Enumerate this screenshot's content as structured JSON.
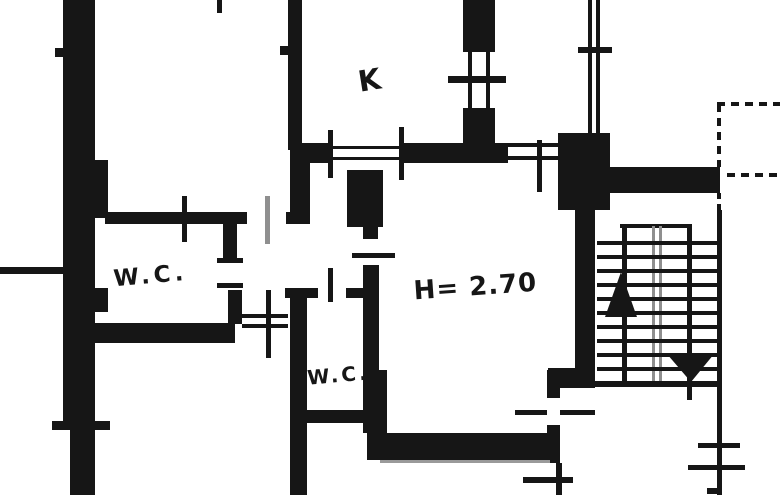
{
  "canvas": {
    "width": 780,
    "height": 495,
    "bg": "#ffffff",
    "ink": "#161616",
    "gray": "#8f8f8f"
  },
  "labels": [
    {
      "id": "label-kitchen",
      "text": "K",
      "x": 371,
      "y": 90,
      "size": 29,
      "rotate": -9,
      "spacing": 0
    },
    {
      "id": "label-wc-1",
      "text": "W.C.",
      "x": 151,
      "y": 283,
      "size": 23,
      "rotate": -5,
      "spacing": 4
    },
    {
      "id": "label-wc-2",
      "text": "W.C.",
      "x": 339,
      "y": 382,
      "size": 20,
      "rotate": -5,
      "spacing": 3
    },
    {
      "id": "label-height",
      "text": "H= 2.70",
      "x": 476,
      "y": 295,
      "size": 26,
      "rotate": -4,
      "spacing": 1
    }
  ],
  "plan": {
    "elements": [
      {
        "t": "rect",
        "n": "wall",
        "x": 63,
        "y": 0,
        "w": 32,
        "h": 160
      },
      {
        "t": "rect",
        "n": "wall",
        "x": 63,
        "y": 160,
        "w": 45,
        "h": 58
      },
      {
        "t": "rect",
        "n": "wall",
        "x": 63,
        "y": 218,
        "w": 32,
        "h": 108
      },
      {
        "t": "rect",
        "n": "wall",
        "x": 63,
        "y": 326,
        "w": 32,
        "h": 104
      },
      {
        "t": "rect",
        "n": "wall",
        "x": 95,
        "y": 288,
        "w": 13,
        "h": 24
      },
      {
        "t": "rect",
        "n": "wall",
        "x": 70,
        "y": 430,
        "w": 25,
        "h": 65
      },
      {
        "t": "rect",
        "n": "door-tick",
        "x": 55,
        "y": 48,
        "w": 9,
        "h": 9
      },
      {
        "t": "rect",
        "n": "wall",
        "x": 0,
        "y": 267,
        "w": 63,
        "h": 7
      },
      {
        "t": "rect",
        "n": "door-tick",
        "x": 52,
        "y": 421,
        "w": 58,
        "h": 9
      },
      {
        "t": "rect",
        "n": "wall-stub",
        "x": 217,
        "y": 0,
        "w": 5,
        "h": 13
      },
      {
        "t": "rect",
        "n": "wall",
        "x": 288,
        "y": 0,
        "w": 14,
        "h": 150
      },
      {
        "t": "rect",
        "n": "door-tick",
        "x": 280,
        "y": 46,
        "w": 8,
        "h": 9
      },
      {
        "t": "rect",
        "n": "wall",
        "x": 290,
        "y": 143,
        "w": 20,
        "h": 81
      },
      {
        "t": "rect",
        "n": "wall",
        "x": 295,
        "y": 143,
        "w": 38,
        "h": 20
      },
      {
        "t": "rect",
        "n": "wall",
        "x": 402,
        "y": 143,
        "w": 106,
        "h": 20
      },
      {
        "t": "rect",
        "n": "door-threshold-line",
        "x": 333,
        "y": 146,
        "w": 69,
        "h": 3
      },
      {
        "t": "rect",
        "n": "door-threshold-line",
        "x": 333,
        "y": 157,
        "w": 69,
        "h": 3
      },
      {
        "t": "rect",
        "n": "door-threshold-line",
        "x": 508,
        "y": 143,
        "w": 54,
        "h": 4
      },
      {
        "t": "rect",
        "n": "door-threshold-line",
        "x": 508,
        "y": 156,
        "w": 54,
        "h": 4
      },
      {
        "t": "rect",
        "n": "door-tick",
        "x": 328,
        "y": 130,
        "w": 5,
        "h": 48
      },
      {
        "t": "rect",
        "n": "door-tick",
        "x": 399,
        "y": 127,
        "w": 5,
        "h": 53
      },
      {
        "t": "rect",
        "n": "door-tick",
        "x": 537,
        "y": 140,
        "w": 5,
        "h": 52
      },
      {
        "t": "rect",
        "n": "wall",
        "x": 463,
        "y": 0,
        "w": 32,
        "h": 52
      },
      {
        "t": "rect",
        "n": "wall",
        "x": 463,
        "y": 108,
        "w": 32,
        "h": 55
      },
      {
        "t": "rect",
        "n": "window-line",
        "x": 468,
        "y": 52,
        "w": 4,
        "h": 56
      },
      {
        "t": "rect",
        "n": "window-line",
        "x": 486,
        "y": 52,
        "w": 4,
        "h": 56
      },
      {
        "t": "rect",
        "n": "door-tick",
        "x": 448,
        "y": 76,
        "w": 58,
        "h": 7
      },
      {
        "t": "rect",
        "n": "window-line",
        "x": 588,
        "y": 0,
        "w": 4,
        "h": 135
      },
      {
        "t": "rect",
        "n": "window-line",
        "x": 596,
        "y": 0,
        "w": 4,
        "h": 135
      },
      {
        "t": "rect",
        "n": "door-tick",
        "x": 578,
        "y": 47,
        "w": 34,
        "h": 6
      },
      {
        "t": "rect",
        "n": "wall",
        "x": 558,
        "y": 133,
        "w": 52,
        "h": 77
      },
      {
        "t": "rect",
        "n": "wall",
        "x": 603,
        "y": 167,
        "w": 117,
        "h": 26
      },
      {
        "t": "rect",
        "n": "wall",
        "x": 575,
        "y": 195,
        "w": 20,
        "h": 193
      },
      {
        "t": "rect",
        "n": "wall",
        "x": 548,
        "y": 368,
        "w": 30,
        "h": 20
      },
      {
        "t": "rect",
        "n": "wall",
        "x": 547,
        "y": 370,
        "w": 13,
        "h": 28
      },
      {
        "t": "rect",
        "n": "wall",
        "x": 547,
        "y": 425,
        "w": 13,
        "h": 38
      },
      {
        "t": "rect",
        "n": "wall-thin",
        "x": 556,
        "y": 463,
        "w": 6,
        "h": 32
      },
      {
        "t": "rect",
        "n": "wall",
        "x": 367,
        "y": 433,
        "w": 190,
        "h": 27
      },
      {
        "t": "rect",
        "n": "wall-shadow-line",
        "x": 380,
        "y": 460,
        "w": 170,
        "h": 3,
        "c": "#9a9a9a"
      },
      {
        "t": "rect",
        "n": "door-tick",
        "x": 515,
        "y": 410,
        "w": 32,
        "h": 5
      },
      {
        "t": "rect",
        "n": "door-tick",
        "x": 560,
        "y": 410,
        "w": 35,
        "h": 5
      },
      {
        "t": "rect",
        "n": "door-tick",
        "x": 523,
        "y": 477,
        "w": 50,
        "h": 6
      },
      {
        "t": "rect",
        "n": "wall-thin",
        "x": 717,
        "y": 210,
        "w": 5,
        "h": 285
      },
      {
        "t": "rect",
        "n": "door-tick",
        "x": 698,
        "y": 443,
        "w": 42,
        "h": 5
      },
      {
        "t": "rect",
        "n": "door-tick",
        "x": 688,
        "y": 465,
        "w": 57,
        "h": 5
      },
      {
        "t": "rect",
        "n": "door-tick",
        "x": 707,
        "y": 488,
        "w": 13,
        "h": 6
      },
      {
        "t": "rect",
        "n": "wall",
        "x": 105,
        "y": 212,
        "w": 142,
        "h": 12
      },
      {
        "t": "rect",
        "n": "wall",
        "x": 286,
        "y": 212,
        "w": 24,
        "h": 12
      },
      {
        "t": "rect",
        "n": "door-tick",
        "x": 182,
        "y": 196,
        "w": 5,
        "h": 46
      },
      {
        "t": "rect",
        "n": "door-leaf-line",
        "x": 265,
        "y": 196,
        "w": 5,
        "h": 48,
        "c": "#8f8f8f"
      },
      {
        "t": "rect",
        "n": "wall",
        "x": 223,
        "y": 224,
        "w": 14,
        "h": 38
      },
      {
        "t": "rect",
        "n": "wall",
        "x": 228,
        "y": 290,
        "w": 14,
        "h": 34
      },
      {
        "t": "rect",
        "n": "door-tick",
        "x": 217,
        "y": 258,
        "w": 26,
        "h": 5
      },
      {
        "t": "rect",
        "n": "door-tick",
        "x": 217,
        "y": 283,
        "w": 26,
        "h": 5
      },
      {
        "t": "rect",
        "n": "wall",
        "x": 95,
        "y": 323,
        "w": 140,
        "h": 20
      },
      {
        "t": "rect",
        "n": "door-threshold-line",
        "x": 242,
        "y": 314,
        "w": 46,
        "h": 4
      },
      {
        "t": "rect",
        "n": "door-threshold-line",
        "x": 242,
        "y": 324,
        "w": 46,
        "h": 4
      },
      {
        "t": "rect",
        "n": "door-tick",
        "x": 266,
        "y": 290,
        "w": 5,
        "h": 68
      },
      {
        "t": "rect",
        "n": "wall",
        "x": 290,
        "y": 290,
        "w": 17,
        "h": 205
      },
      {
        "t": "rect",
        "n": "wall",
        "x": 285,
        "y": 288,
        "w": 33,
        "h": 10
      },
      {
        "t": "rect",
        "n": "wall",
        "x": 346,
        "y": 288,
        "w": 31,
        "h": 10
      },
      {
        "t": "rect",
        "n": "door-tick",
        "x": 328,
        "y": 268,
        "w": 5,
        "h": 34
      },
      {
        "t": "rect",
        "n": "wall",
        "x": 300,
        "y": 410,
        "w": 67,
        "h": 13
      },
      {
        "t": "rect",
        "n": "wall",
        "x": 347,
        "y": 170,
        "w": 36,
        "h": 57
      },
      {
        "t": "rect",
        "n": "wall",
        "x": 363,
        "y": 227,
        "w": 15,
        "h": 12
      },
      {
        "t": "rect",
        "n": "door-tick",
        "x": 352,
        "y": 253,
        "w": 43,
        "h": 5
      },
      {
        "t": "rect",
        "n": "wall",
        "x": 363,
        "y": 265,
        "w": 16,
        "h": 168
      },
      {
        "t": "rect",
        "n": "wall",
        "x": 367,
        "y": 370,
        "w": 20,
        "h": 63
      },
      {
        "t": "rect",
        "n": "stair-landing-line",
        "x": 620,
        "y": 224,
        "w": 72,
        "h": 4
      },
      {
        "t": "rect",
        "n": "stair-stringer",
        "x": 622,
        "y": 224,
        "w": 5,
        "h": 157
      },
      {
        "t": "rect",
        "n": "stair-stringer",
        "x": 687,
        "y": 224,
        "w": 5,
        "h": 176
      },
      {
        "t": "rect",
        "n": "stair-rail-line",
        "x": 652,
        "y": 226,
        "w": 3,
        "h": 155,
        "c": "#8f8f8f"
      },
      {
        "t": "rect",
        "n": "stair-rail-line",
        "x": 659,
        "y": 226,
        "w": 3,
        "h": 155,
        "c": "#8f8f8f"
      },
      {
        "t": "rect",
        "n": "stair-tread",
        "x": 597,
        "y": 241,
        "w": 121,
        "h": 4
      },
      {
        "t": "rect",
        "n": "stair-tread",
        "x": 597,
        "y": 255,
        "w": 121,
        "h": 4
      },
      {
        "t": "rect",
        "n": "stair-tread",
        "x": 597,
        "y": 269,
        "w": 121,
        "h": 4
      },
      {
        "t": "rect",
        "n": "stair-tread",
        "x": 597,
        "y": 283,
        "w": 121,
        "h": 4
      },
      {
        "t": "rect",
        "n": "stair-tread",
        "x": 597,
        "y": 297,
        "w": 121,
        "h": 4
      },
      {
        "t": "rect",
        "n": "stair-tread",
        "x": 597,
        "y": 311,
        "w": 121,
        "h": 4
      },
      {
        "t": "rect",
        "n": "stair-tread",
        "x": 597,
        "y": 325,
        "w": 121,
        "h": 4
      },
      {
        "t": "rect",
        "n": "stair-tread",
        "x": 597,
        "y": 339,
        "w": 121,
        "h": 4
      },
      {
        "t": "rect",
        "n": "stair-tread",
        "x": 597,
        "y": 353,
        "w": 121,
        "h": 4
      },
      {
        "t": "rect",
        "n": "stair-tread",
        "x": 597,
        "y": 367,
        "w": 121,
        "h": 4
      },
      {
        "t": "rect",
        "n": "stair-bottom-line",
        "x": 593,
        "y": 381,
        "w": 129,
        "h": 6
      },
      {
        "t": "poly",
        "n": "stair-arrow-up",
        "pts": "621,272 605,317 637,317"
      },
      {
        "t": "poly",
        "n": "stair-arrow-down",
        "pts": "667,354 714,354 691,382"
      },
      {
        "t": "line",
        "n": "balcony-dashed-line",
        "x1": 717,
        "y1": 104,
        "x2": 780,
        "y2": 104,
        "w": 4,
        "dash": "8 6"
      },
      {
        "t": "line",
        "n": "balcony-dashed-line",
        "x1": 719,
        "y1": 104,
        "x2": 719,
        "y2": 167,
        "w": 4,
        "dash": "8 6"
      },
      {
        "t": "line",
        "n": "balcony-dashed-line",
        "x1": 727,
        "y1": 175,
        "x2": 780,
        "y2": 175,
        "w": 4,
        "dash": "8 6"
      },
      {
        "t": "line",
        "n": "balcony-dashed-line",
        "x1": 719,
        "y1": 193,
        "x2": 719,
        "y2": 218,
        "w": 4,
        "dash": "6 5"
      }
    ]
  }
}
